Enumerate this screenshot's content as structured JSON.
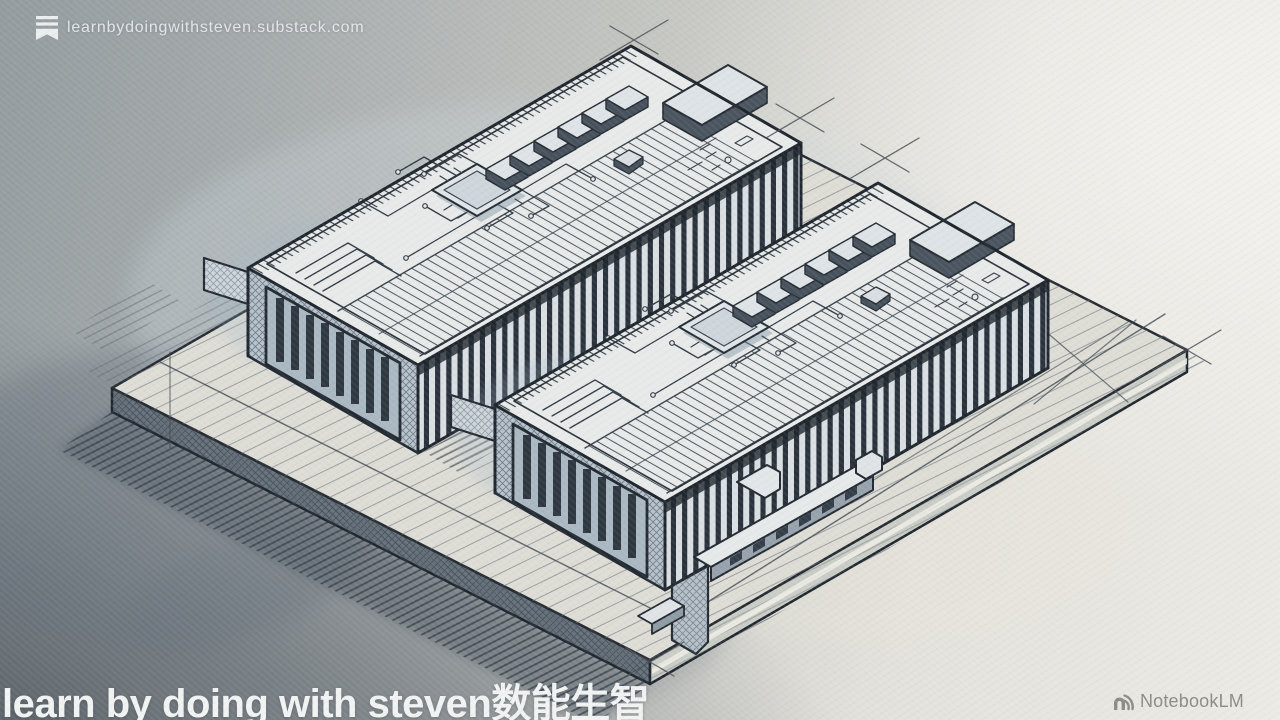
{
  "overlay": {
    "publisher": {
      "url": "learnbydoingwithsteven.substack.com",
      "icon": "substack-bookmark-icon"
    },
    "caption": {
      "text": "learn by doing with steven数能生智"
    },
    "brand": {
      "label": "NotebookLM",
      "icon": "notebooklm-icon"
    }
  },
  "illustration": {
    "alt": "Hand-drawn isometric pencil-and-wash sketch of two finned accelerator modules with circuit boards, CPU dies, memory chips and edge connectors, mounted on a rectangular base plate with construction lines and hatched shadows",
    "style": "ink sketch with blue-gray watercolor wash"
  },
  "colors": {
    "paper_highlight": "#f1f0ec",
    "paper_shadow": "#5a626a",
    "ink": "#232a32",
    "wash_blue": "#9fb6c6",
    "fin_dark": "#2a323c",
    "caption_text": "#f1f3f3",
    "url_text": "#e6eaec",
    "brand_text": "#8b8c85"
  }
}
